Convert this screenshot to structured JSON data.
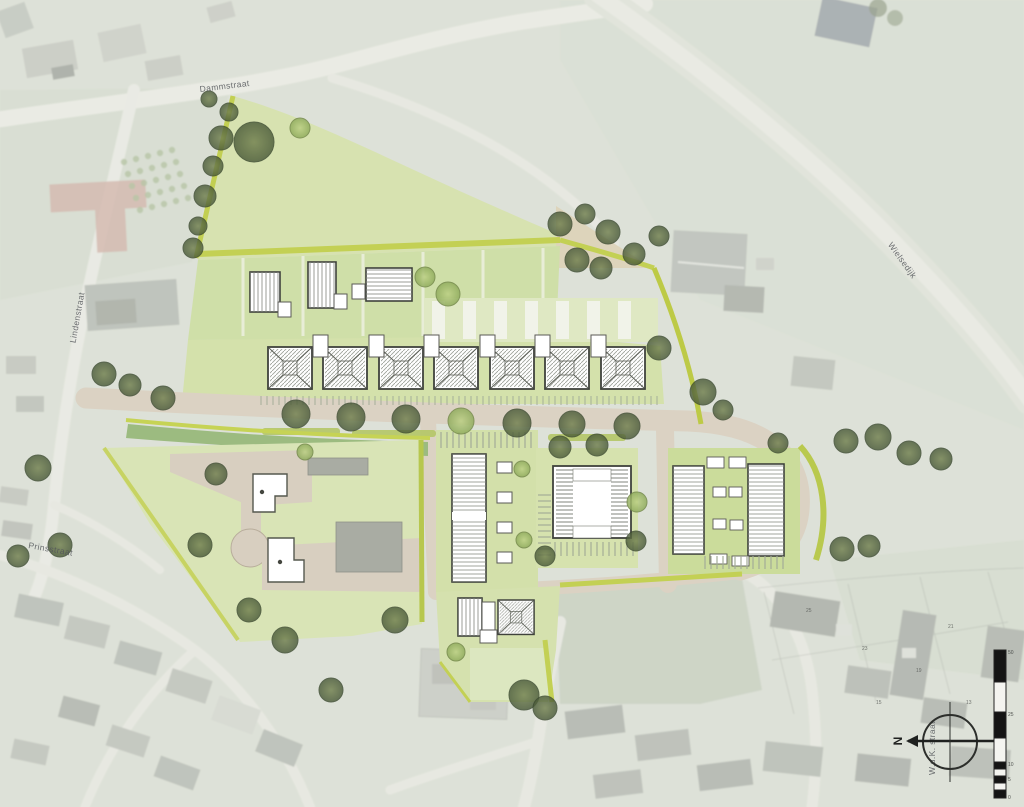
{
  "street_labels": {
    "top": "Dammstraat",
    "left": "Lindenstraat",
    "right": "Wielsedijk",
    "bottom_left": "Prinsstraat",
    "bottom_right": "W.d.K. straat"
  },
  "compass": {
    "north": "N"
  },
  "scale_bar": {
    "ticks": [
      "50",
      "25",
      "10",
      "5",
      "0"
    ]
  },
  "house_numbers": [
    "25",
    "23",
    "21",
    "19",
    "15",
    "13"
  ],
  "colors": {
    "aerial_base": "#ced3c8",
    "plan_green": "#d5e0ad",
    "plan_green_bright": "#cbdc9b",
    "hedge_green": "#bcca45",
    "wadi_green": "#9cbb80",
    "road_beige": "#dbd2c3",
    "tree_olive": "#55663f",
    "building_outline": "#3f423c"
  }
}
